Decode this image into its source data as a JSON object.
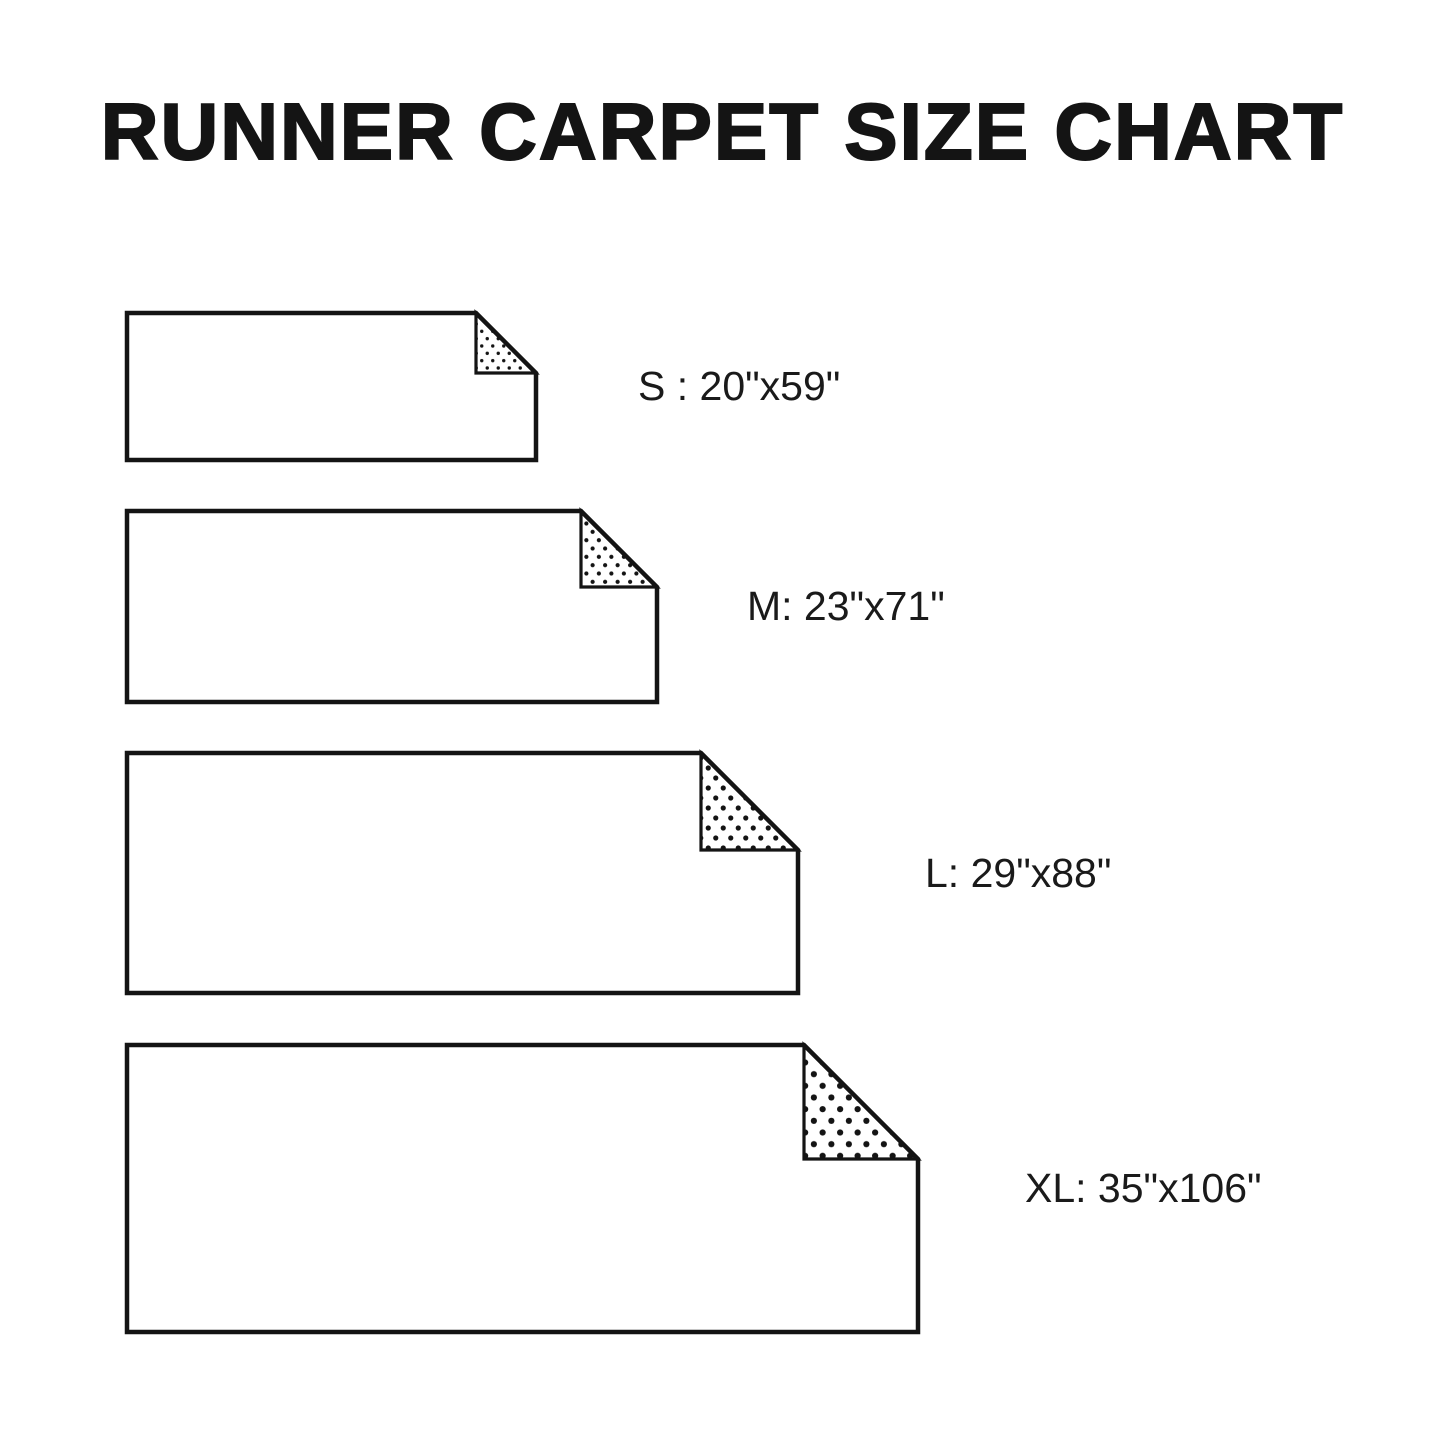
{
  "title": "RUNNER CARPET SIZE CHART",
  "colors": {
    "background": "#ffffff",
    "ink": "#141414",
    "label_text": "#1a1a1a"
  },
  "chart_data": {
    "type": "table",
    "title": "RUNNER CARPET SIZE CHART",
    "columns": [
      "size",
      "dimensions"
    ],
    "rows": [
      [
        "S",
        "20\"x59\""
      ],
      [
        "M",
        "23\"x71\""
      ],
      [
        "L",
        "29\"x88\""
      ],
      [
        "XL",
        "35\"x106\""
      ]
    ]
  },
  "rugs": [
    {
      "id": "s",
      "label": "S : 20\"x59\"",
      "px": {
        "left": 127,
        "top": 313,
        "width": 409,
        "height": 147,
        "fold": 60,
        "dot_spacing": 11,
        "dot_radius": 1.7
      },
      "label_px": {
        "left": 638,
        "center_y": 386
      }
    },
    {
      "id": "m",
      "label": "M: 23\"x71\"",
      "px": {
        "left": 127,
        "top": 511,
        "width": 530,
        "height": 191,
        "fold": 76,
        "dot_spacing": 12.5,
        "dot_radius": 2.1
      },
      "label_px": {
        "left": 747,
        "center_y": 606
      }
    },
    {
      "id": "l",
      "label": "L: 29\"x88\"",
      "px": {
        "left": 127,
        "top": 753,
        "width": 671,
        "height": 240,
        "fold": 97,
        "dot_spacing": 15,
        "dot_radius": 2.6
      },
      "label_px": {
        "left": 925,
        "center_y": 873
      }
    },
    {
      "id": "xl",
      "label": "XL: 35\"x106\"",
      "px": {
        "left": 127,
        "top": 1045,
        "width": 791,
        "height": 287,
        "fold": 114,
        "dot_spacing": 17.5,
        "dot_radius": 3.1
      },
      "label_px": {
        "left": 1025,
        "center_y": 1188
      }
    }
  ]
}
